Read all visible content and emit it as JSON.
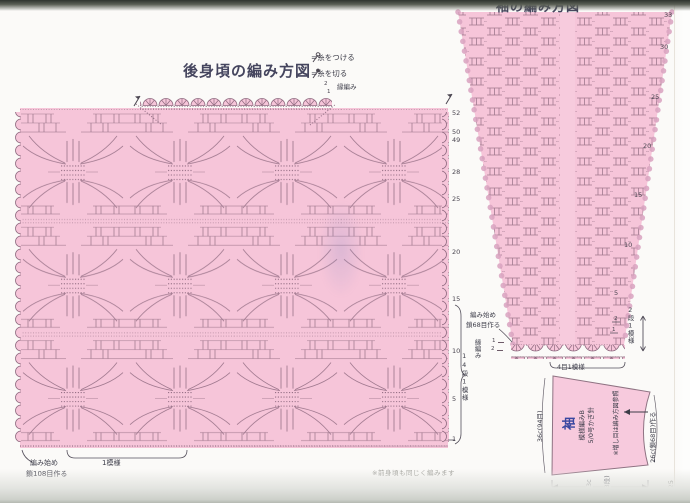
{
  "colors": {
    "chart_pink": "#f6c5d9",
    "stitch_symbol": "#8f6a80",
    "title_ink": "#45455e",
    "part_blue": "#3947a0"
  },
  "back_chart": {
    "title": "後身頃の編み方図",
    "legend": [
      {
        "icon": "yarn-attach-icon",
        "label": "=糸をつける"
      },
      {
        "icon": "yarn-cut-icon",
        "label": "=糸を切る"
      }
    ],
    "edging_label": "縁編み",
    "edging_rows": [
      "2",
      "1"
    ],
    "row_numbers": [
      "52",
      "50",
      "49",
      "28",
      "25",
      "20",
      "15",
      "10",
      "5",
      "1"
    ],
    "vertical_repeat": "14段1模様",
    "start_line1": "編み始め",
    "start_line2": "鎖108目作る",
    "h_repeat": "1模様",
    "note": "※前身頃も同じく編みます"
  },
  "sleeve_chart": {
    "title": "袖の編み方図",
    "row_numbers": [
      "33",
      "30",
      "25",
      "20",
      "15",
      "10",
      "5"
    ],
    "repeat_marks": [
      "2",
      "1"
    ],
    "start_line1": "編み始め",
    "start_line2": "鎖68目作る",
    "edging_label": "縁編み",
    "edging_rows": [
      "1",
      "2"
    ],
    "v_repeat": "2段1模様",
    "h_repeat": "4目1模様"
  },
  "schematic": {
    "part": "袖",
    "stitch": "模様編みB",
    "hook": "5/0号かぎ針",
    "note": "※増し目は編み方図参照",
    "dim_left": "36c(94目)",
    "dim_right": "26c(鎖68目)作る",
    "dim_bottom_value": "33c",
    "dim_bottom_rows": "(33段)"
  },
  "page_number": "125"
}
